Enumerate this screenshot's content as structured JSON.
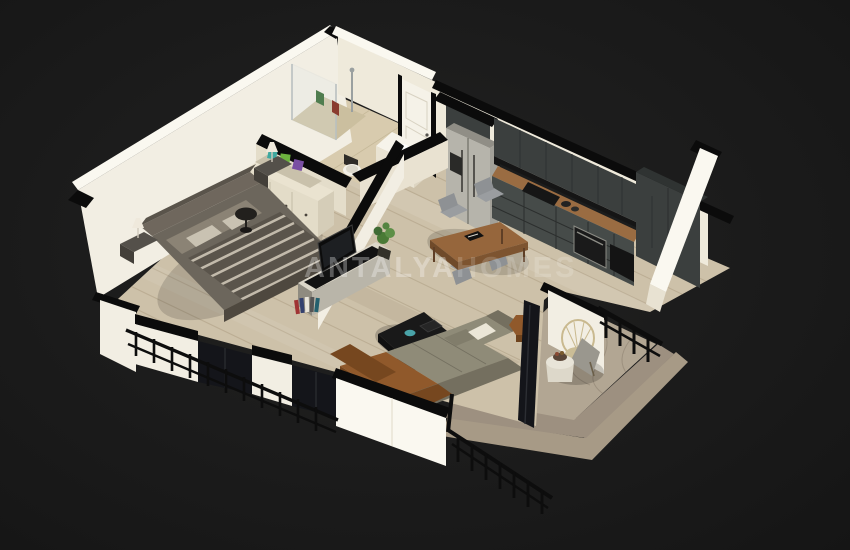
{
  "scene": {
    "description": "3D isometric render of a one-bedroom apartment floor plan on black background",
    "watermark": {
      "brand": "ANTALYA",
      "suffix": "HOMES"
    },
    "background": "#1b1b1b",
    "colors": {
      "wall_white": "#f2eee3",
      "wall_bright": "#faf8f0",
      "wall_shadow": "#e4ddca",
      "wall_cap": "#0b0b0b",
      "floor_wood": "#cdc1a9",
      "plank_line": "#b2a489",
      "floor_bath": "#d8cbae",
      "marble": "#b2a693",
      "marble_dark": "#9d9080",
      "marble_step": "#a79a86",
      "cabinet_dark": "#3b3f3e",
      "cabinet_face": "#464b49",
      "appliance_black": "#161616",
      "counter_wood": "#9a6c42",
      "fridge_steel": "#b6b4ab",
      "table_wood": "#96663c",
      "chair_gray": "#9a9da0",
      "sofa_gray": "#8f8b78",
      "sofa_gray_dark": "#746f5f",
      "sofa_brown": "#90592b",
      "sofa_brown_dark": "#76471f",
      "pillow_white": "#ebe6d7",
      "coffee_table": "#191919",
      "teal_accent": "#49a3a8",
      "bed_duvet": "#5a544b",
      "bed_stripe": "#cec6b6",
      "bed_pillow": "#8b8375",
      "headboard": "#6f675d",
      "dresser_cream": "#eae3d0",
      "door_white": "#f5f2e8",
      "glass_dark": "#14151a",
      "rail_black": "#0d0d0d",
      "plant_green": "#4a7a36",
      "lamp_white": "#efe9dc",
      "wicker": "#c9b98f",
      "throw_gray": "#9a978e"
    },
    "rooms": [
      {
        "id": "bedroom",
        "furniture": [
          "double-bed",
          "headboard",
          "nightstands",
          "table-lamps",
          "open-wardrobe",
          "round-side-table"
        ]
      },
      {
        "id": "bathroom",
        "furniture": [
          "shower-enclosure",
          "toilet",
          "washbasin-cabinet"
        ]
      },
      {
        "id": "hallway",
        "furniture": [
          "entrance-door"
        ]
      },
      {
        "id": "kitchen",
        "furniture": [
          "refrigerator",
          "upper-cabinets",
          "lower-cabinets",
          "cooktop",
          "oven",
          "tall-cabinet"
        ]
      },
      {
        "id": "living-dining",
        "furniture": [
          "dining-table",
          "dining-chairs",
          "tv-console",
          "tv",
          "books",
          "plant",
          "coffee-table",
          "sectional-sofa",
          "hex-side-table"
        ]
      },
      {
        "id": "terrace",
        "furniture": [
          "wicker-chair",
          "round-table",
          "railing",
          "marble-steps"
        ]
      }
    ]
  }
}
